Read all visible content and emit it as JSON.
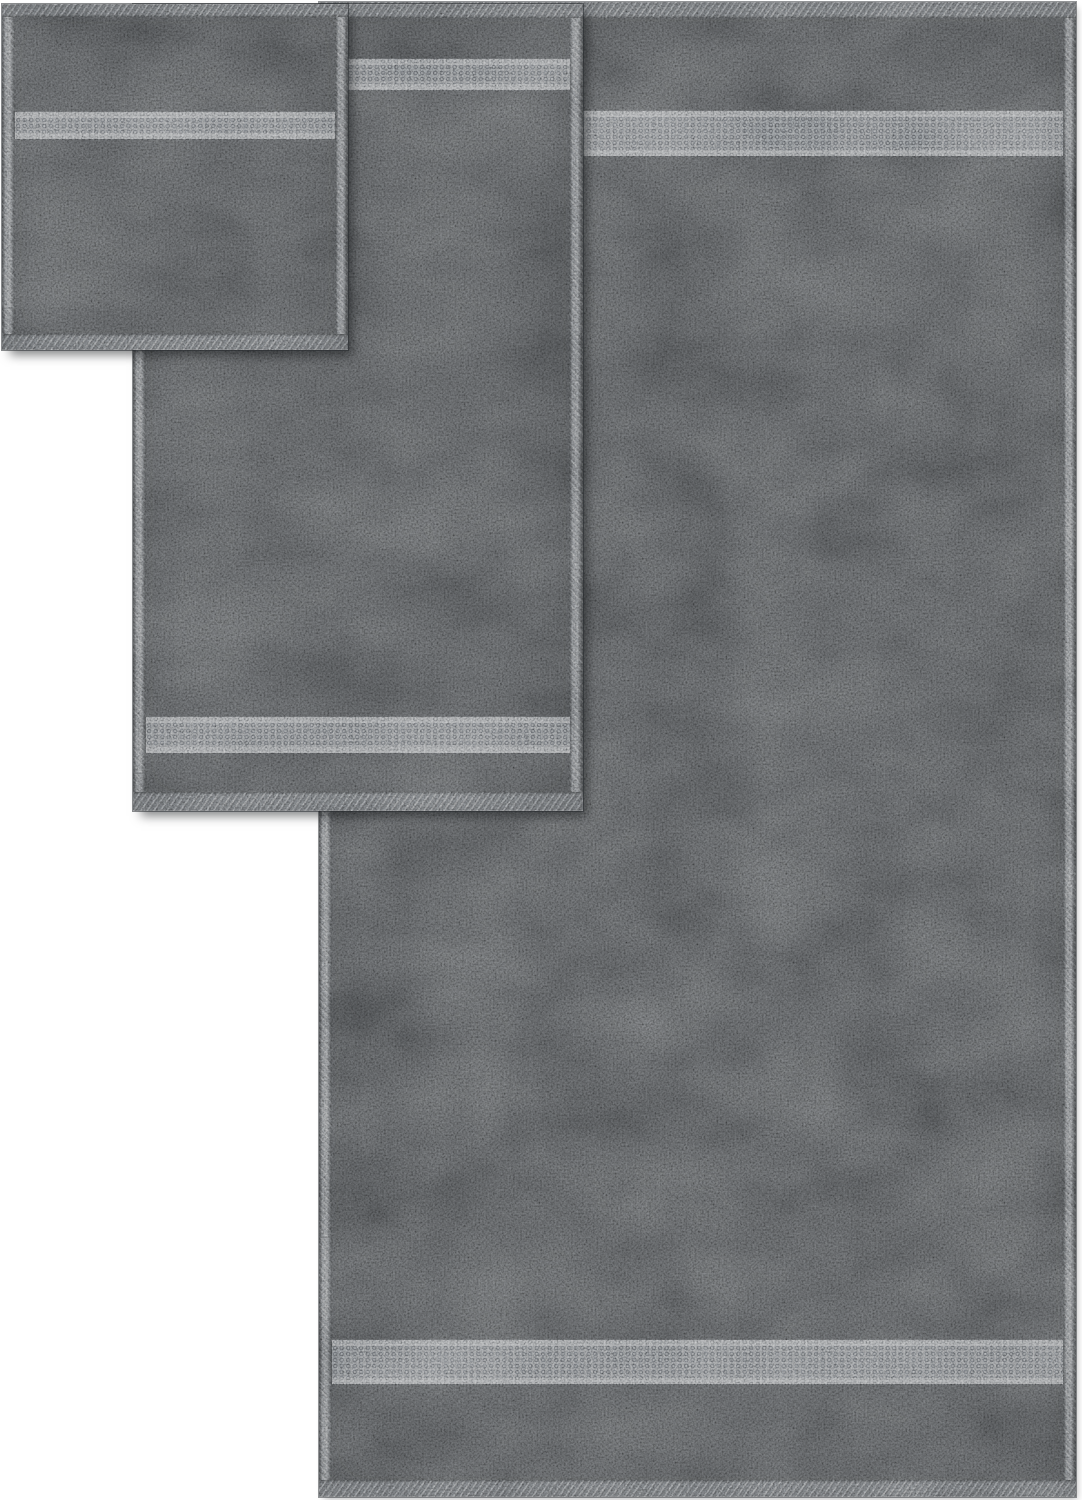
{
  "scene": {
    "kind": "product-photo",
    "description": "Three overlapping charcoal gray terry cotton towels on a white background, each with diagonal-stitched hems and a lighter dotted dobby border band near the ends",
    "background_color": "#ffffff",
    "colors": {
      "towel_body": "#47494b",
      "dobby_band": "#76797c",
      "hem_edge": "#5e6164"
    },
    "objects": [
      {
        "id": "bath-towel",
        "label": "Bath towel"
      },
      {
        "id": "hand-towel",
        "label": "Hand towel"
      },
      {
        "id": "washcloth",
        "label": "Washcloth"
      }
    ]
  }
}
